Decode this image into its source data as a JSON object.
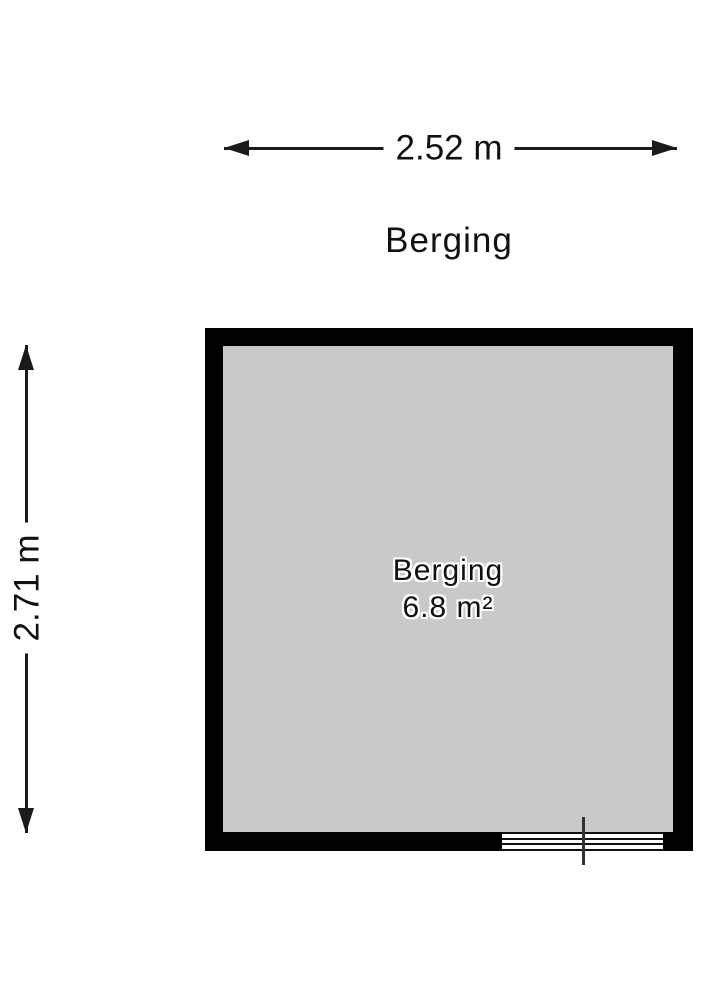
{
  "plan": {
    "title": "Berging",
    "room": {
      "name": "Berging",
      "area": "6.8 m²"
    },
    "dimensions": {
      "width_label": "2.52 m",
      "height_label": "2.71 m"
    },
    "symbols": {
      "window": "window-with-center-tick"
    },
    "colors": {
      "wall": "#000000",
      "floor": "#c9c9c9",
      "dimension_line": "#1a1a1a",
      "text": "#111111",
      "text_halo": "#ffffff",
      "background": "#ffffff"
    }
  }
}
